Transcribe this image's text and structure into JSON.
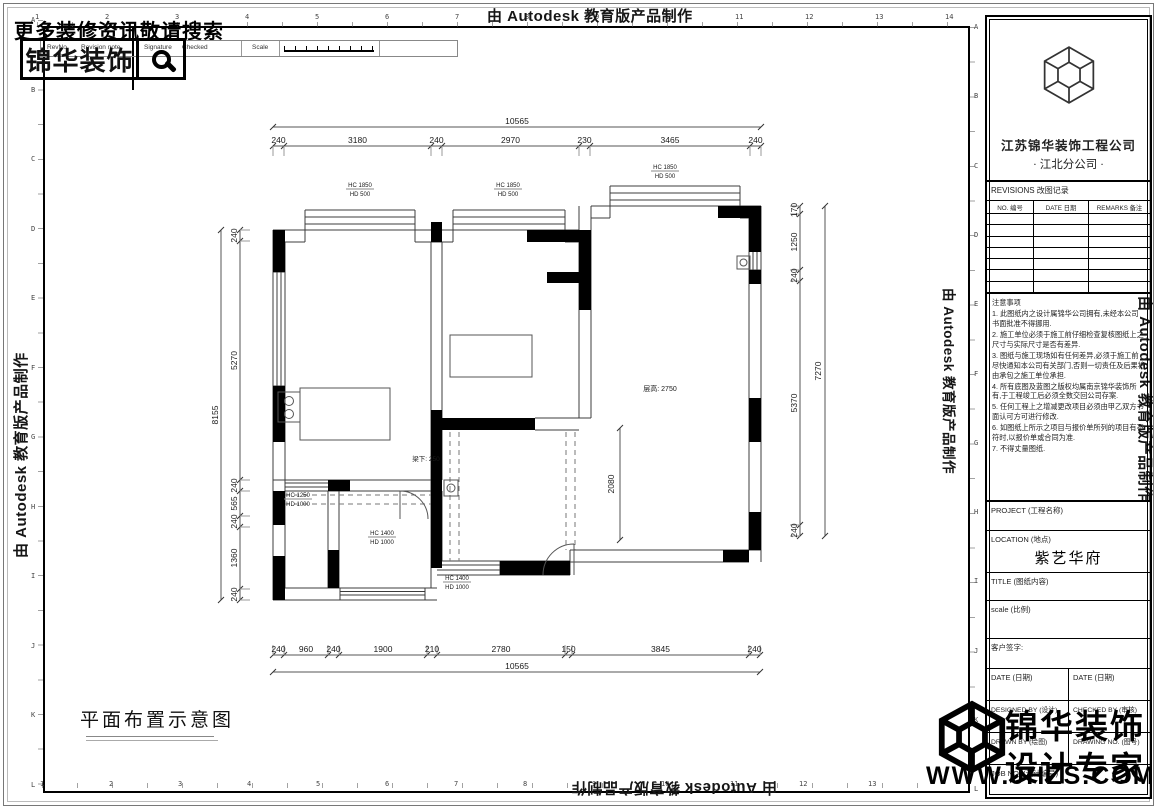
{
  "autodesk_credit": "由 Autodesk 教育版产品制作",
  "header": {
    "search_hint": "更多装修资讯敬请搜索",
    "logo_text": "锦华装饰",
    "strip": {
      "revno": "RevNo.",
      "revision_note": "Revision note",
      "signature": "Signature",
      "checked": "Checked",
      "scale": "Scale"
    }
  },
  "ruler": {
    "top_numbers": [
      "1",
      "2",
      "3",
      "4",
      "5",
      "6",
      "7",
      "8",
      "9",
      "10",
      "11",
      "12",
      "13",
      "14"
    ],
    "bottom_numbers": [
      "1",
      "2",
      "3",
      "4",
      "5",
      "6",
      "7",
      "8",
      "9",
      "10",
      "11",
      "12",
      "13"
    ],
    "left_letters": [
      "A",
      "B",
      "C",
      "D",
      "E",
      "F",
      "G",
      "H",
      "I",
      "J",
      "K",
      "L"
    ],
    "right_letters": [
      "A",
      "B",
      "C",
      "D",
      "E",
      "F",
      "G",
      "H",
      "I",
      "J",
      "K",
      "L"
    ]
  },
  "plan": {
    "title": "平面布置示意图",
    "dims": {
      "top_total": "10565",
      "top": [
        "240",
        "3180",
        "240",
        "2970",
        "230",
        "3465",
        "240"
      ],
      "bottom": [
        "240",
        "960",
        "240",
        "1900",
        "210",
        "2780",
        "150",
        "3845",
        "240"
      ],
      "bottom_total": "10565",
      "left_total": "8155",
      "left": [
        "240",
        "5270",
        "240",
        "565",
        "240",
        "1360",
        "240"
      ],
      "right": [
        "170",
        "1250",
        "240",
        "5370",
        "240"
      ],
      "right_total": "7270",
      "opening": "2080"
    },
    "win_labels": [
      {
        "top": "HC 1850",
        "bot": "HD 500"
      },
      {
        "top": "HC 1850",
        "bot": "HD 500"
      },
      {
        "top": "HC 1850",
        "bot": "HD 500"
      },
      {
        "top": "HC 1250",
        "bot": "HD 1000"
      },
      {
        "top": "HC 1400",
        "bot": "HD 1000"
      },
      {
        "top": "HC 1400",
        "bot": "HD 1000"
      }
    ],
    "beam_label": "梁下: 250",
    "height_label": "层高: 2750"
  },
  "title_block": {
    "company": "江苏锦华装饰工程公司",
    "branch": "·  江北分公司  ·",
    "revisions_title": "REVISIONS 改图记录",
    "rev_cols": [
      "NO. 编号",
      "DATE 日期",
      "REMARKS 备注"
    ],
    "notes_title": "注意事项",
    "notes": [
      "1. 此图纸内之设计属锦华公司拥有,未经本公司书面批准不得挪用.",
      "2. 施工单位必须于施工前仔细检查复核图纸上之尺寸与实际尺寸是否有差异.",
      "3. 图纸与施工现场如有任何差异,必须于施工前尽快通知本公司有关部门,否则一切责任及后果将由承包之施工单位承担.",
      "4. 所有底图及蓝图之版权均属南京锦华装饰所有,于工程竣工后必须全数交回公司存案.",
      "5. 任何工程上之增减更改项目必须由甲乙双方书面认可方可进行修改.",
      "6. 如图纸上所示之项目与报价单所列的项目有不符时,以报价单或合同为准.",
      "7. 不得丈量图纸."
    ],
    "project_label": "PROJECT (工程名称)",
    "location_label": "LOCATION (地点)",
    "location_value": "紫艺华府",
    "title_label": "TITLE (图纸内容)",
    "scale_label": "scale  (比例)",
    "client_sign": "客户签字:",
    "date_label_left": "DATE (日期)",
    "date_label_right": "DATE (日期)",
    "designed_by": "DESIGNED BY (设计)",
    "checked_by": "CHECKED BY (审核)",
    "drawn_by": "DRAWN BY (绘图)",
    "drawing_no": "DRAWING NO. (图号)",
    "job_no": "JOB NO. (设计编号)"
  },
  "watermark": {
    "line1": "锦华装饰",
    "line2": "设计专家",
    "url": "WWW.JHZS.COM"
  }
}
